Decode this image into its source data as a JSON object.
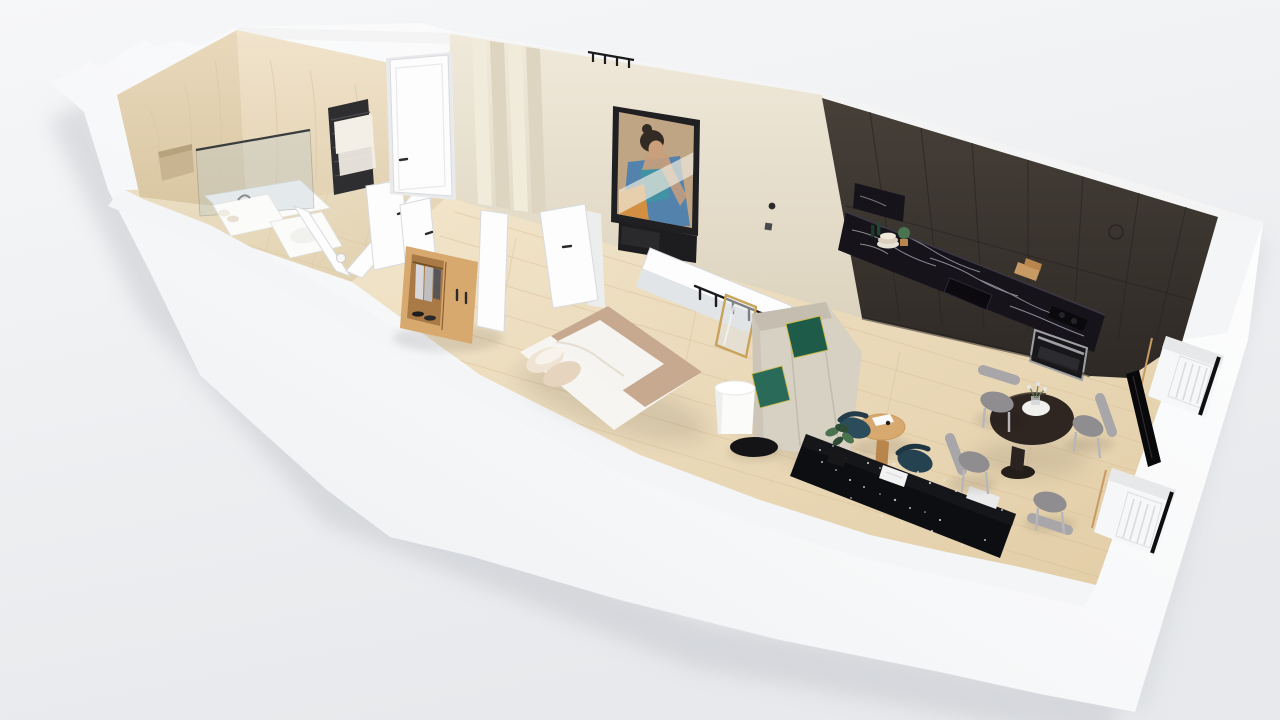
{
  "scene": {
    "type": "3d-floor-plan-render",
    "view": "isometric-cutaway",
    "text_content": "none"
  },
  "palette": {
    "bg_top": "#f6f7f8",
    "bg_bottom": "#e7e9ec",
    "shell": "#fcfdfe",
    "shell_shade": "#e9ebee",
    "band_top": "#f3f4f3",
    "wall_inner_face": "#f3f5f6",
    "marble": "#e6d5b6",
    "marble_light": "#efe2ca",
    "marble_vein": "#d8c5a2",
    "niche": "#c9b491",
    "cream_wall": "#ece5d5",
    "cream_wall_dark": "#ded5c1",
    "panel_light": "#f1ebdb",
    "floor_wood": "#f0e3c9",
    "floor_wood_dark": "#e2cda6",
    "plank": "#d9c29c",
    "floor_tile": "#ecdfc4",
    "tile_line": "#d9c8a6",
    "kitchen_dark": "#453e39",
    "kitchen_darker": "#2f2a26",
    "kitchen_seam": "#2a2522",
    "counter_black": "#16131b",
    "vein_white": "#d8dae0",
    "steel": "#9fa0a4",
    "oven_black": "#17171a",
    "door_white": "#fdfdfe",
    "door_edge": "#d8dadd",
    "handle_dark": "#2b2b2e",
    "glass": "#b8c8cd",
    "radiator_black": "#2e2e31",
    "towel": "#f3efe6",
    "frame_black": "#202023",
    "tv_black": "#1d1d20",
    "art_bg": "#c0a585",
    "art_hair": "#332a24",
    "art_skin": "#c99f7c",
    "art_blue": "#4a7fb0",
    "art_teal": "#3f95a5",
    "art_orange": "#d28f42",
    "art_light": "#efe9dd",
    "bed_white": "#f7f5f1",
    "blanket": "#c7a98f",
    "pillow": "#e8d8c6",
    "sofa": "#d7d1c4",
    "sofa_dark": "#c5beb0",
    "green": "#1e5c49",
    "green2": "#2a6a58",
    "trim_yellow": "#cdb84d",
    "wood": "#d8a96f",
    "wood_dark": "#b8854c",
    "teal_chair": "#2b4c5a",
    "teal_chair2": "#254251",
    "table_brown": "#2f2622",
    "chair_gray": "#a8a6a8",
    "chair_gray_dark": "#8f8d90",
    "desk_black": "#0d0e11",
    "speckle": "#f0f0f2",
    "radiator_white": "#f6f7f8",
    "radiator_rib": "#d9dbde",
    "window_frame": "#0f0f12",
    "sill_tan": "#c89a64",
    "gold": "#c9a35c",
    "plant_green": "#4a7350",
    "plant_dark": "#2f4d36",
    "pot_black": "#17171a"
  },
  "rooms": [
    {
      "name": "bathroom",
      "items": [
        "marble-wall",
        "wall-niche",
        "shower-glass",
        "shower-tray",
        "sink",
        "toilet",
        "towel-radiator",
        "toilet-paper-holder",
        "doors"
      ]
    },
    {
      "name": "hallway",
      "items": [
        "entry-door",
        "fluted-panels",
        "wardrobe",
        "wardrobe-door",
        "coat-rack"
      ]
    },
    {
      "name": "bedroom",
      "items": [
        "double-bed",
        "artwork",
        "tv",
        "bedroom-door",
        "half-wall",
        "coat-hooks",
        "mirror"
      ]
    },
    {
      "name": "kitchen",
      "items": [
        "tall-cabinets",
        "marble-backsplash",
        "shelf-niche",
        "sink",
        "hob",
        "oven",
        "plates",
        "plant",
        "cutting-boards"
      ]
    },
    {
      "name": "living_room",
      "items": [
        "sofa",
        "green-cushions",
        "floor-lamp",
        "side-table",
        "coffee-table",
        "lounge-chairs",
        "terrazzo-desk",
        "books",
        "plant",
        "tv"
      ]
    },
    {
      "name": "dining_area",
      "items": [
        "round-table",
        "plate",
        "flowers",
        "chair",
        "chair",
        "chair",
        "chair"
      ]
    },
    {
      "name": "exterior",
      "items": [
        "outer-walls",
        "window",
        "window",
        "radiator",
        "radiator"
      ]
    }
  ]
}
